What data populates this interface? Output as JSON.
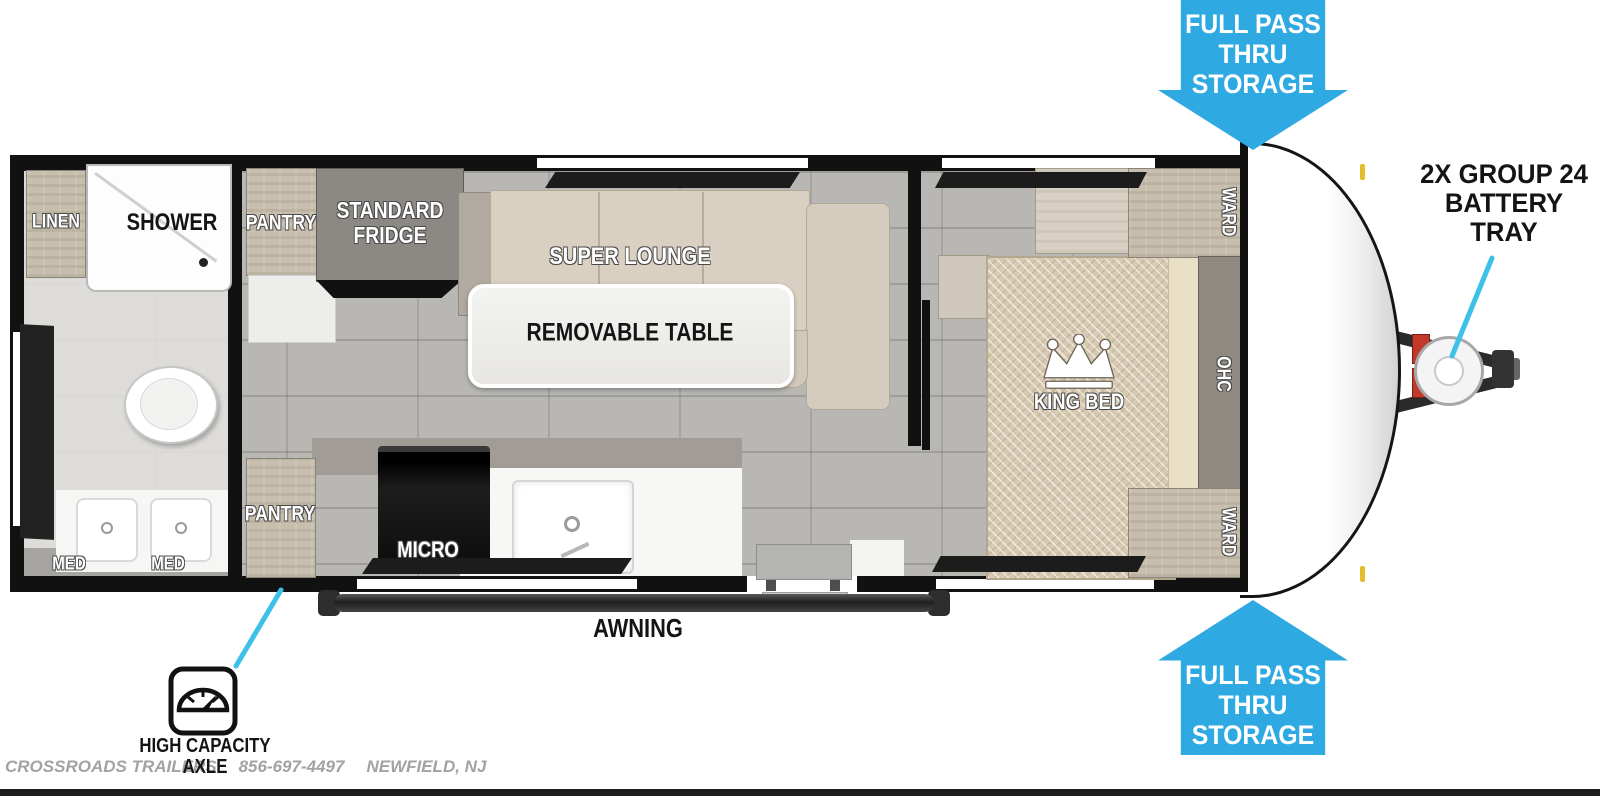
{
  "callouts": {
    "storage_top": "FULL PASS\nTHRU\nSTORAGE",
    "storage_bottom": "FULL PASS\nTHRU\nSTORAGE",
    "battery_tray": "2X GROUP 24\nBATTERY\nTRAY",
    "high_capacity_axle": "HIGH CAPACITY\nAXLE",
    "awning": "AWNING"
  },
  "labels": {
    "linen": "LINEN",
    "shower": "SHOWER",
    "pantry_top": "PANTRY",
    "fridge": "STANDARD\nFRIDGE",
    "lounge": "SUPER LOUNGE",
    "table": "REMOVABLE TABLE",
    "med_left": "MED",
    "med_right": "MED",
    "pantry_bottom": "PANTRY",
    "micro": "MICRO",
    "king_bed": "KING BED",
    "ward_top": "WARD",
    "ward_bottom": "WARD",
    "ohc": "OHC"
  },
  "footer": {
    "dealer": "CROSSROADS TRAILERS",
    "phone": "856-697-4497",
    "location": "NEWFIELD, NJ"
  },
  "colors": {
    "arrow_blue": "#2fa9e1",
    "callout_line": "#3ec1e8",
    "battery_red": "#c0392b",
    "wall": "#111111"
  }
}
